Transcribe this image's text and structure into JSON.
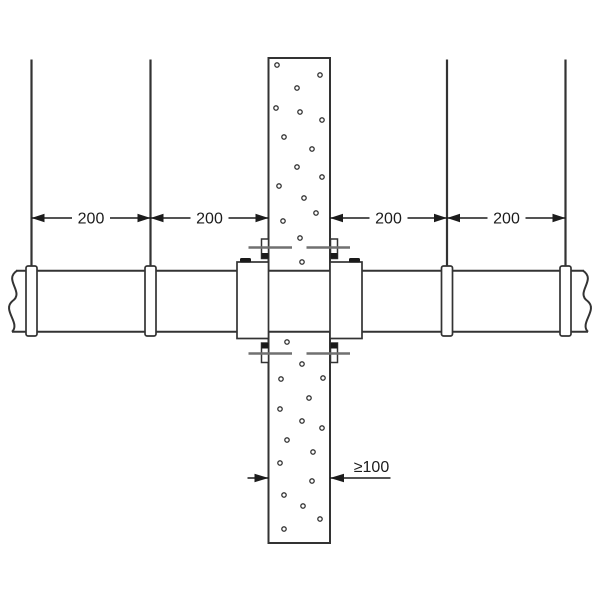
{
  "drawing": {
    "type": "pipe-penetration-detail",
    "components": [
      "concrete-column",
      "pipe",
      "hanger-rods",
      "pipe-clamps",
      "coupling-collars",
      "anchor-bolts"
    ],
    "dimensions": [
      {
        "label": "200"
      },
      {
        "label": "200"
      },
      {
        "label": "200"
      },
      {
        "label": "200"
      }
    ],
    "thickness": {
      "label": "≥100"
    },
    "colors": {
      "line": "#333333",
      "dimension": "#1c1c1c",
      "fastener": "#707070",
      "nut": "#1a1a1a",
      "background": "#ffffff"
    },
    "stipple_dots": [
      [
        277,
        65
      ],
      [
        320,
        75
      ],
      [
        297,
        88
      ],
      [
        276,
        108
      ],
      [
        300,
        112
      ],
      [
        322,
        120
      ],
      [
        284,
        137
      ],
      [
        312,
        149
      ],
      [
        297,
        167
      ],
      [
        322,
        177
      ],
      [
        279,
        186
      ],
      [
        304,
        198
      ],
      [
        316,
        213
      ],
      [
        283,
        221
      ],
      [
        300,
        238
      ],
      [
        302,
        262
      ],
      [
        287,
        342
      ],
      [
        302,
        364
      ],
      [
        281,
        379
      ],
      [
        323,
        378
      ],
      [
        309,
        398
      ],
      [
        280,
        409
      ],
      [
        302,
        421
      ],
      [
        322,
        428
      ],
      [
        287,
        440
      ],
      [
        313,
        452
      ],
      [
        280,
        463
      ],
      [
        312,
        481
      ],
      [
        284,
        495
      ],
      [
        303,
        506
      ],
      [
        320,
        519
      ],
      [
        284,
        529
      ]
    ]
  }
}
